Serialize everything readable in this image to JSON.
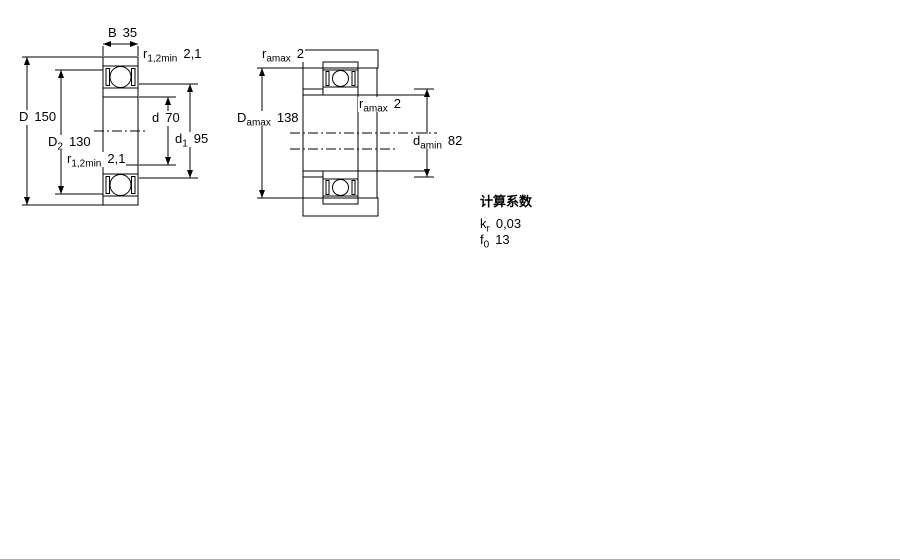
{
  "figure_left": {
    "labels": {
      "B": {
        "base": "B",
        "value": "35"
      },
      "D": {
        "base": "D",
        "value": "150"
      },
      "D2": {
        "base": "D",
        "sub": "2",
        "value": "130"
      },
      "r12_top": {
        "base": "r",
        "sub": "1,2min",
        "value": "2,1"
      },
      "r12_bot": {
        "base": "r",
        "sub": "1,2min",
        "value": "2,1"
      },
      "d": {
        "base": "d",
        "value": "70"
      },
      "d1": {
        "base": "d",
        "sub": "1",
        "value": "95"
      }
    }
  },
  "figure_right": {
    "labels": {
      "ramax_top": {
        "base": "r",
        "sub": "amax",
        "value": "2"
      },
      "Damax": {
        "base": "D",
        "sub": "amax",
        "value": "138"
      },
      "ramax_mid": {
        "base": "r",
        "sub": "amax",
        "value": "2"
      },
      "damin": {
        "base": "d",
        "sub": "amin",
        "value": "82"
      }
    }
  },
  "calculation_factors": {
    "title": "计算系数",
    "rows": [
      {
        "base": "k",
        "sub": "r",
        "value": "0,03"
      },
      {
        "base": "f",
        "sub": "0",
        "value": "13"
      }
    ]
  },
  "colors": {
    "section_fill": "#b6d0e6",
    "section_dot": "#9cb8d2",
    "bore_fill": "#f2f2f2",
    "line": "#000000"
  }
}
